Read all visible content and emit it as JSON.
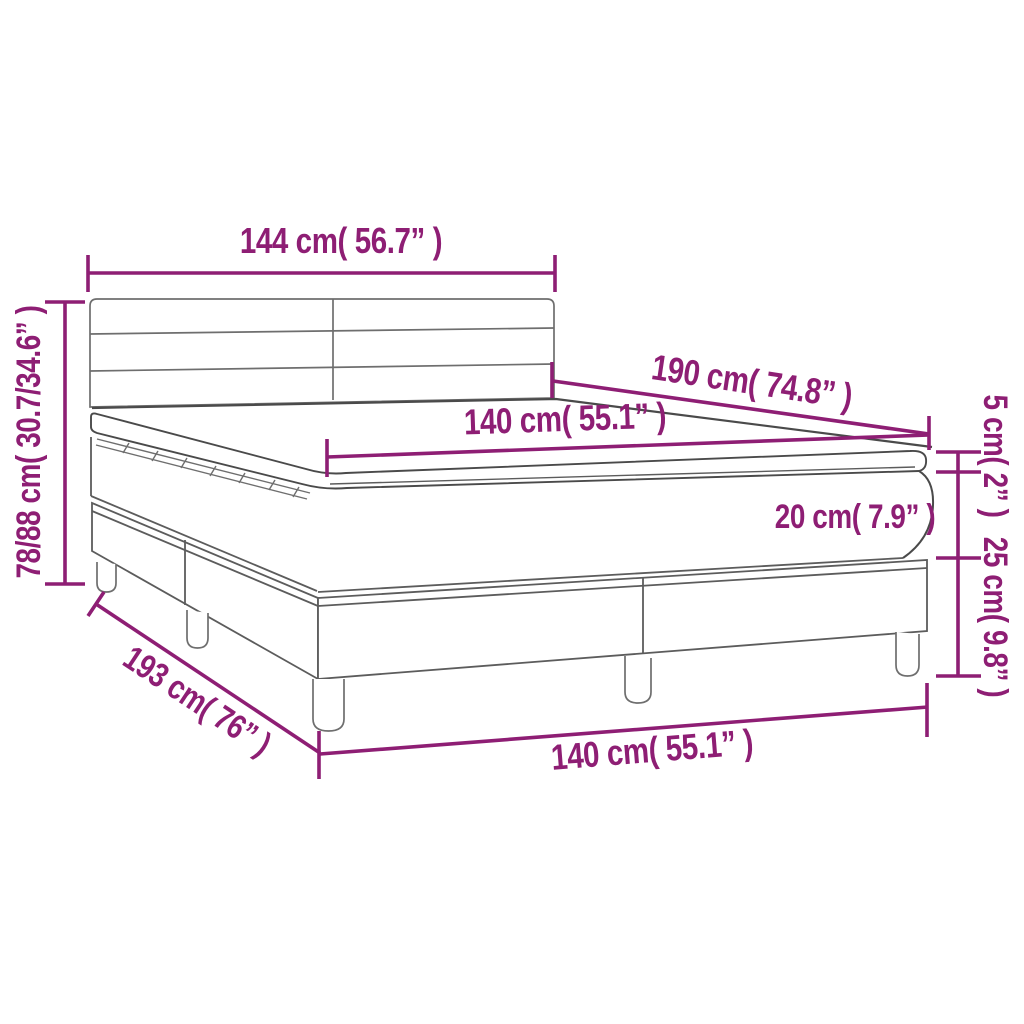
{
  "diagram": {
    "subject": "box-spring-bed-with-topper-dimension-diagram",
    "colors": {
      "background": "#ffffff",
      "accent": "#8e1e74",
      "outline_dark": "#4a4a4a",
      "outline_light": "#6e6e6e"
    },
    "labels": {
      "width_top": "144 cm( 56.7” )",
      "height_left": "78/88 cm( 30.7/34.6” )",
      "length_top": "190 cm( 74.8” )",
      "width_mattress": "140 cm( 55.1” )",
      "topper_height": "5 cm( 2” )",
      "mattress_height": "20 cm( 7.9” )",
      "base_height": "25 cm( 9.8” )",
      "length_bottom": "193 cm( 76” )",
      "width_bottom": "140 cm( 55.1” )"
    }
  }
}
